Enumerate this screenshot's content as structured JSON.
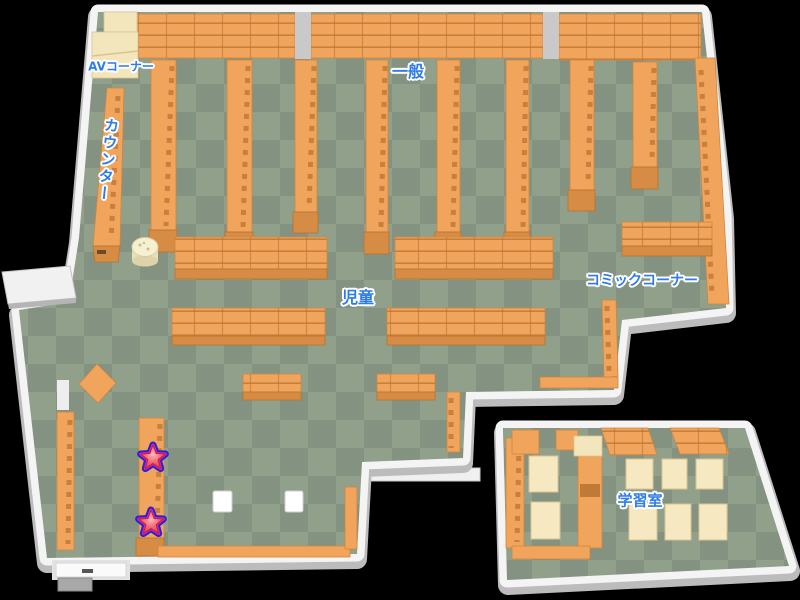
{
  "map_labels": {
    "av_corner": "AVコーナー",
    "counter": "カウンター",
    "general": "一般",
    "children": "児童",
    "comic_corner": "コミックコーナー",
    "study_room": "学習室"
  },
  "markers": {
    "stars": [
      {
        "name": "star-marker-1",
        "transform": "translate(153,458)"
      },
      {
        "name": "star-marker-2",
        "transform": "translate(151,523)"
      }
    ],
    "star_fill": "#e8404e",
    "star_ring": "#d41ed4",
    "star_outline": "#2824c9"
  },
  "colors": {
    "background": "#000000",
    "wall": "#f4f4f4",
    "wall_shadow": "#bcbcbc",
    "floor_light": "#91a08b",
    "floor_dark": "#849282",
    "shelf_orange": "#f1a45c",
    "shelf_front": "#d68c44",
    "furniture_cream": "#f3e6bd",
    "label_text": "#2e7ce8"
  }
}
